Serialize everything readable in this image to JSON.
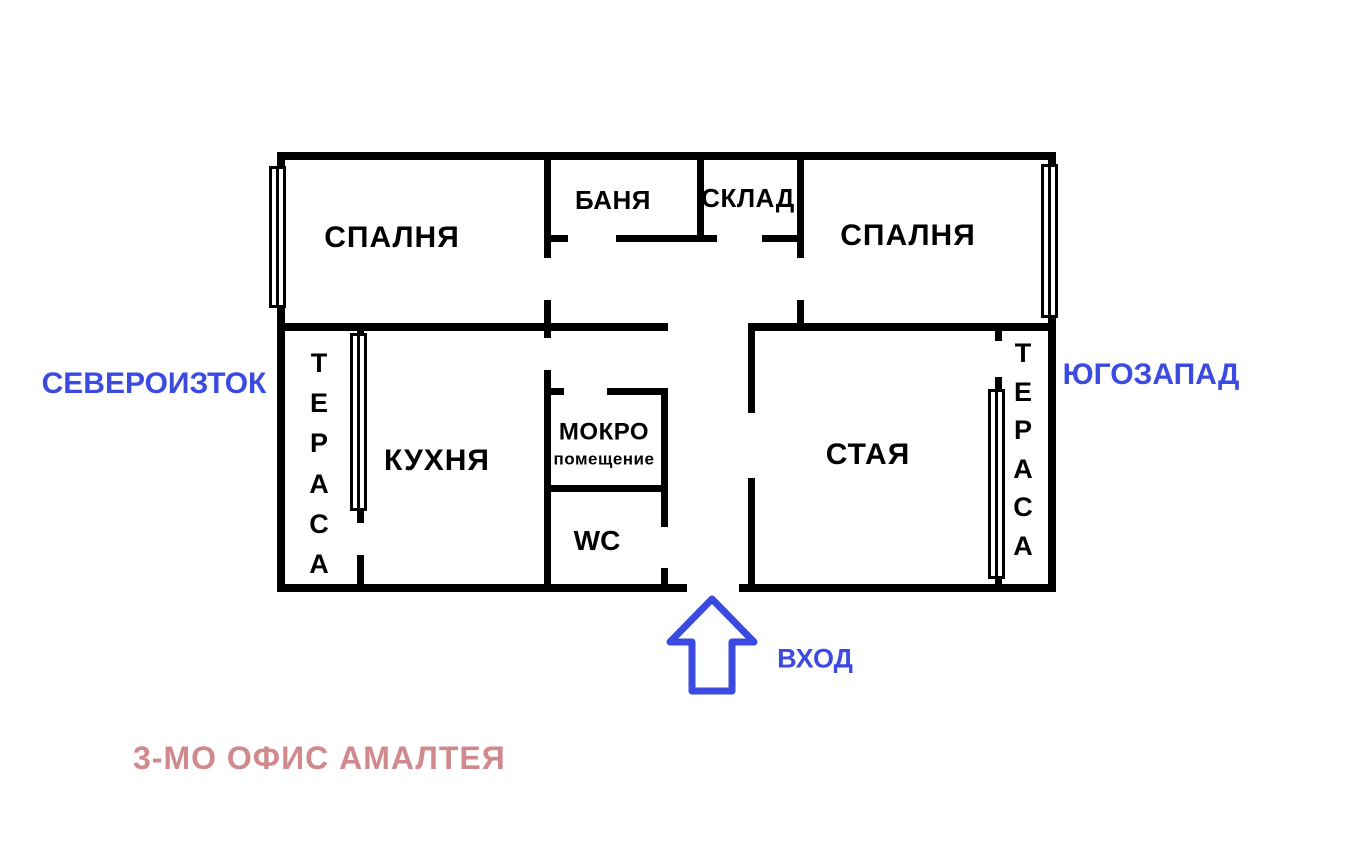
{
  "title": {
    "text": "3-МО ОФИС АМАЛТЕЯ"
  },
  "directions": {
    "northeast": "СЕВЕРОИЗТОК",
    "southwest": "ЮГОЗАПАД"
  },
  "entrance": {
    "label": "ВХОД",
    "arrow_icon": "arrow-up-outline"
  },
  "rooms": {
    "bedroom_left": "СПАЛНЯ",
    "bathroom": "БАНЯ",
    "storage": "СКЛАД",
    "bedroom_right": "СПАЛНЯ",
    "kitchen": "КУХНЯ",
    "wet_room_line1": "МОКРО",
    "wet_room_line2": "помещение",
    "wc": "WC",
    "living_room": "СТАЯ"
  },
  "terraces": {
    "left": {
      "letters": [
        "Т",
        "Е",
        "Р",
        "А",
        "С",
        "А"
      ]
    },
    "right": {
      "letters": [
        "Т",
        "Е",
        "Р",
        "А",
        "С",
        "А"
      ]
    }
  },
  "colors": {
    "walls": "#000000",
    "accent_blue": "#3b4ae0",
    "title_pink": "#d08a8d",
    "background": "#ffffff"
  }
}
